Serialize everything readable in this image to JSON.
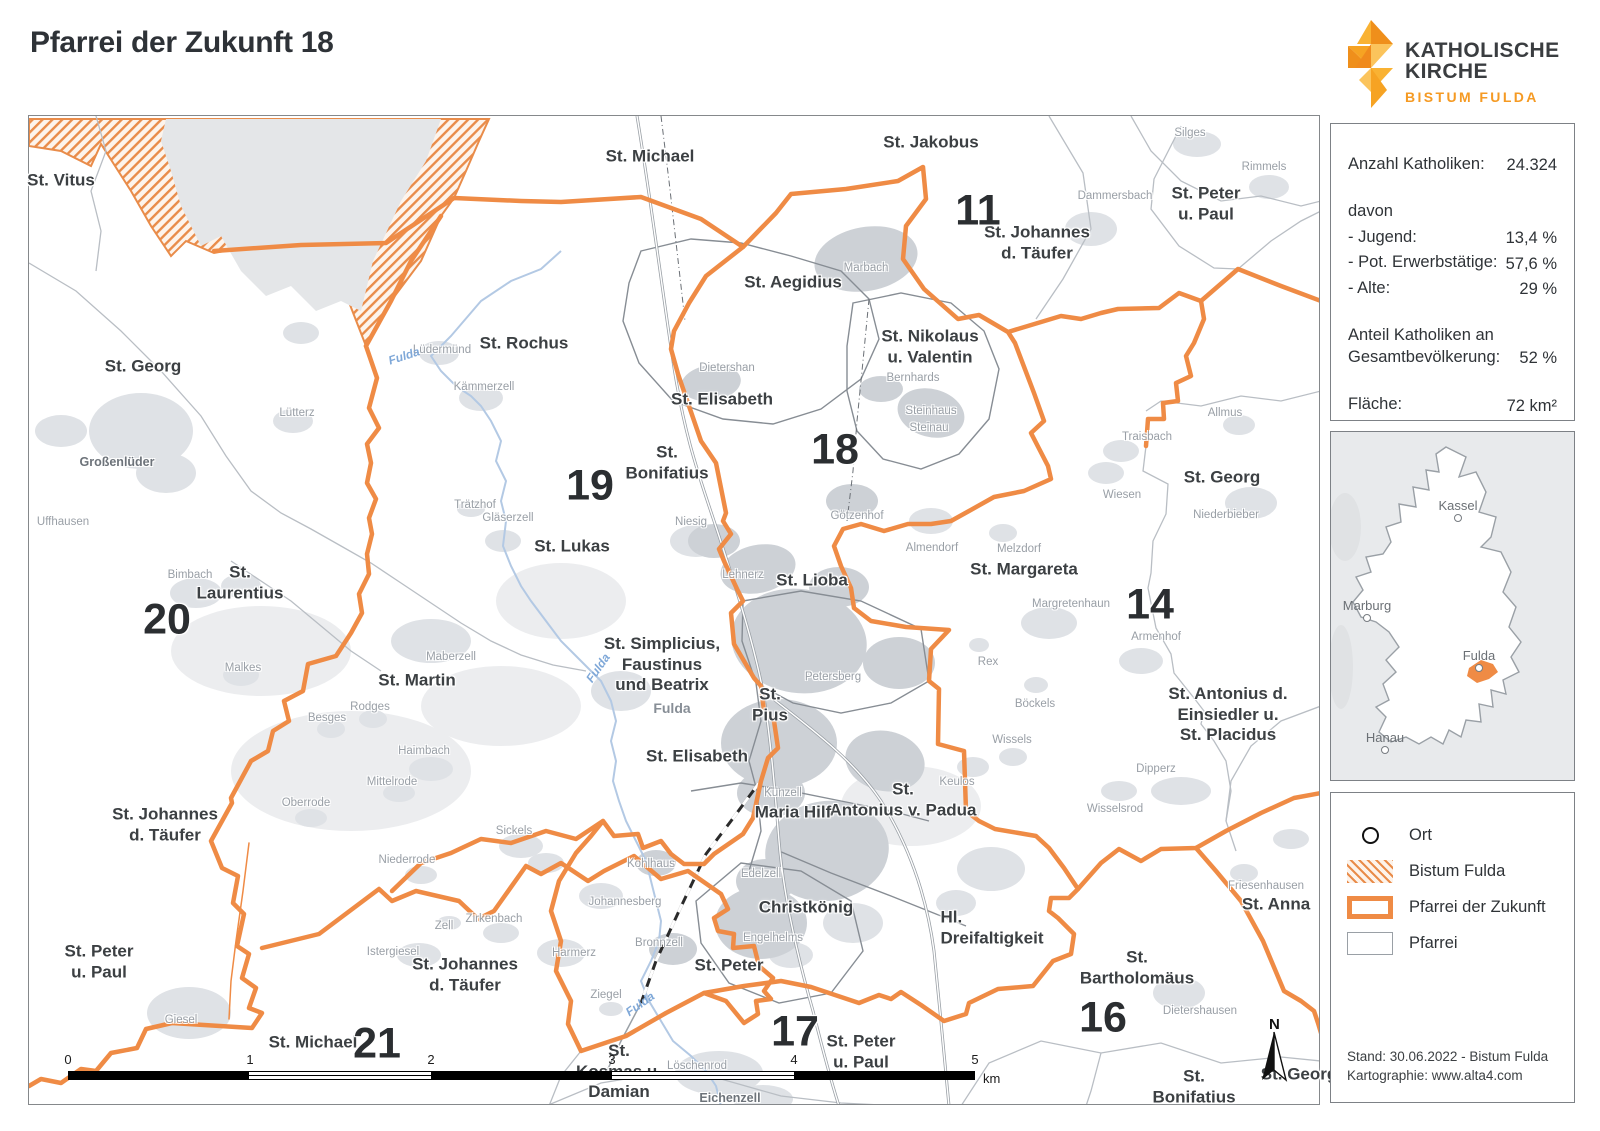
{
  "header": {
    "title": "Pfarrei der Zukunft 18",
    "logo": {
      "line1": "KATHOLISCHE",
      "line2": "KIRCHE",
      "line3": "BISTUM FULDA"
    }
  },
  "colors": {
    "accent": "#ef8b45",
    "logo_orange": "#f59a23",
    "hatch": "#e98c4a",
    "parish_line": "#b9bec4",
    "water": "#b3c9e4"
  },
  "stats": {
    "anzahl_label": "Anzahl Katholiken:",
    "anzahl_value": "24.324",
    "davon_label": "davon",
    "jugend_label": "- Jugend:",
    "jugend_value": "13,4 %",
    "erwerb_label": "- Pot. Erwerbstätige:",
    "erwerb_value": "57,6 %",
    "alte_label": "- Alte:",
    "alte_value": "29 %",
    "anteil_label": "Anteil Katholiken an\nGesamtbevölkerung:",
    "anteil_value": "52 %",
    "flaeche_label": "Fläche:",
    "flaeche_value": "72 km²"
  },
  "overview": {
    "cities": [
      {
        "name": "Kassel",
        "x": 127,
        "y": 86
      },
      {
        "name": "Marburg",
        "x": 36,
        "y": 186
      },
      {
        "name": "Fulda",
        "x": 148,
        "y": 236
      },
      {
        "name": "Hanau",
        "x": 54,
        "y": 318
      }
    ]
  },
  "legend": {
    "items": [
      {
        "label": "Ort"
      },
      {
        "label": "Bistum Fulda"
      },
      {
        "label": "Pfarrei der Zukunft"
      },
      {
        "label": "Pfarrei"
      }
    ],
    "footer_line1": "Stand: 30.06.2022 - Bistum Fulda",
    "footer_line2": "Kartographie: www.alta4.com"
  },
  "map": {
    "north_label": "N",
    "scale_bar": {
      "ticks": [
        {
          "text": "0",
          "x": 0,
          "y": -4
        },
        {
          "text": "1",
          "x": 182,
          "y": -4
        },
        {
          "text": "2",
          "x": 363,
          "y": -4
        },
        {
          "text": "3",
          "x": 544,
          "y": -4
        },
        {
          "text": "4",
          "x": 726,
          "y": -4
        },
        {
          "text": "5",
          "x": 907,
          "y": -4
        }
      ],
      "unit": "km"
    },
    "region_numbers": [
      {
        "text": "11",
        "x": 978,
        "y": 211
      },
      {
        "text": "18",
        "x": 835,
        "y": 450
      },
      {
        "text": "19",
        "x": 590,
        "y": 486
      },
      {
        "text": "20",
        "x": 167,
        "y": 620
      },
      {
        "text": "14",
        "x": 1150,
        "y": 605
      },
      {
        "text": "17",
        "x": 795,
        "y": 1032
      },
      {
        "text": "16",
        "x": 1103,
        "y": 1018
      },
      {
        "text": "21",
        "x": 377,
        "y": 1044
      }
    ],
    "parish_labels": [
      {
        "text": "St. Vitus",
        "x": 61,
        "y": 181
      },
      {
        "text": "St. Michael",
        "x": 650,
        "y": 157
      },
      {
        "text": "St. Jakobus",
        "x": 931,
        "y": 143
      },
      {
        "text": "St. Peter\nu. Paul",
        "x": 1206,
        "y": 204
      },
      {
        "text": "St. Johannes\nd. Täufer",
        "x": 1037,
        "y": 243
      },
      {
        "text": "St. Aegidius",
        "x": 793,
        "y": 283
      },
      {
        "text": "St. Nikolaus\nu. Valentin",
        "x": 930,
        "y": 347
      },
      {
        "text": "St. Rochus",
        "x": 524,
        "y": 344
      },
      {
        "text": "St. Georg",
        "x": 143,
        "y": 367
      },
      {
        "text": "St. Elisabeth",
        "x": 722,
        "y": 400
      },
      {
        "text": "St.\nBonifatius",
        "x": 667,
        "y": 463
      },
      {
        "text": "St. Georg",
        "x": 1222,
        "y": 478
      },
      {
        "text": "St. Lukas",
        "x": 572,
        "y": 547
      },
      {
        "text": "St.\nLaurentius",
        "x": 240,
        "y": 583
      },
      {
        "text": "St. Lioba",
        "x": 812,
        "y": 581
      },
      {
        "text": "St. Margareta",
        "x": 1024,
        "y": 570
      },
      {
        "text": "St. Simplicius,\nFaustinus\nund Beatrix",
        "x": 662,
        "y": 665
      },
      {
        "text": "St. Martin",
        "x": 417,
        "y": 681
      },
      {
        "text": "St. Antonius d.\nEinsiedler u.\nSt. Placidus",
        "x": 1228,
        "y": 715
      },
      {
        "text": "St.\nPius",
        "x": 770,
        "y": 705
      },
      {
        "text": "St. Elisabeth",
        "x": 697,
        "y": 757
      },
      {
        "text": "St.\nAntonius v. Padua",
        "x": 903,
        "y": 800
      },
      {
        "text": "Maria Hilf",
        "x": 793,
        "y": 813
      },
      {
        "text": "St. Johannes\nd. Täufer",
        "x": 165,
        "y": 825
      },
      {
        "text": "Christkönig",
        "x": 806,
        "y": 908
      },
      {
        "text": "Hl.\nDreifaltigkeit",
        "x": 992,
        "y": 928,
        "cls": "align-left"
      },
      {
        "text": "St. Anna",
        "x": 1276,
        "y": 905
      },
      {
        "text": "St. Peter\nu. Paul",
        "x": 99,
        "y": 962
      },
      {
        "text": "St. Johannes\nd. Täufer",
        "x": 465,
        "y": 975
      },
      {
        "text": "St. Peter",
        "x": 729,
        "y": 966
      },
      {
        "text": "St.\nBartholomäus",
        "x": 1137,
        "y": 968
      },
      {
        "text": "St. Michael",
        "x": 313,
        "y": 1043
      },
      {
        "text": "St. Peter\nu. Paul",
        "x": 861,
        "y": 1052
      },
      {
        "text": "St.\nKosmas u.\nDamian",
        "x": 619,
        "y": 1072
      },
      {
        "text": "St.\nBonifatius",
        "x": 1194,
        "y": 1087
      },
      {
        "text": "St. Georg",
        "x": 1299,
        "y": 1075
      }
    ],
    "place_labels": [
      {
        "text": "Silges",
        "x": 1190,
        "y": 133
      },
      {
        "text": "Rimmels",
        "x": 1264,
        "y": 167
      },
      {
        "text": "Dammersbach",
        "x": 1115,
        "y": 196
      },
      {
        "text": "Marbach",
        "x": 866,
        "y": 268
      },
      {
        "text": "Dietershan",
        "x": 727,
        "y": 368
      },
      {
        "text": "Bernhards",
        "x": 913,
        "y": 378
      },
      {
        "text": "Steinhaus",
        "x": 931,
        "y": 411
      },
      {
        "text": "Steinau",
        "x": 929,
        "y": 428
      },
      {
        "text": "Lüdermünd",
        "x": 442,
        "y": 350
      },
      {
        "text": "Kämmerzell",
        "x": 484,
        "y": 387
      },
      {
        "text": "Lütterz",
        "x": 297,
        "y": 413
      },
      {
        "text": "Großenlüder",
        "x": 117,
        "y": 462,
        "cls": "strong"
      },
      {
        "text": "Uffhausen",
        "x": 63,
        "y": 522
      },
      {
        "text": "Trätzhof",
        "x": 475,
        "y": 505
      },
      {
        "text": "Gläserzell",
        "x": 508,
        "y": 518
      },
      {
        "text": "Niesig",
        "x": 691,
        "y": 522
      },
      {
        "text": "Bimbach",
        "x": 190,
        "y": 575
      },
      {
        "text": "Malkes",
        "x": 243,
        "y": 668
      },
      {
        "text": "Maberzell",
        "x": 451,
        "y": 657
      },
      {
        "text": "Rodges",
        "x": 370,
        "y": 707
      },
      {
        "text": "Besges",
        "x": 327,
        "y": 718
      },
      {
        "text": "Haimbach",
        "x": 424,
        "y": 751
      },
      {
        "text": "Mittelrode",
        "x": 392,
        "y": 782
      },
      {
        "text": "Oberrode",
        "x": 306,
        "y": 803
      },
      {
        "text": "Sickels",
        "x": 514,
        "y": 831
      },
      {
        "text": "Niederrode",
        "x": 407,
        "y": 860
      },
      {
        "text": "Zell",
        "x": 444,
        "y": 926
      },
      {
        "text": "Zirkenbach",
        "x": 494,
        "y": 919
      },
      {
        "text": "Istergiesel",
        "x": 393,
        "y": 952
      },
      {
        "text": "Harmerz",
        "x": 574,
        "y": 953
      },
      {
        "text": "Johannesberg",
        "x": 625,
        "y": 902
      },
      {
        "text": "Kohlhaus",
        "x": 651,
        "y": 864
      },
      {
        "text": "Bronnzell",
        "x": 659,
        "y": 943
      },
      {
        "text": "Ziegel",
        "x": 606,
        "y": 995
      },
      {
        "text": "Giesel",
        "x": 181,
        "y": 1020
      },
      {
        "text": "Edelzell",
        "x": 761,
        "y": 874
      },
      {
        "text": "Engelhelms",
        "x": 773,
        "y": 938
      },
      {
        "text": "Löschenrod",
        "x": 697,
        "y": 1066
      },
      {
        "text": "Eichenzell",
        "x": 730,
        "y": 1098,
        "cls": "strong"
      },
      {
        "text": "Petersberg",
        "x": 833,
        "y": 677
      },
      {
        "text": "Künzell",
        "x": 783,
        "y": 793
      },
      {
        "text": "Keulos",
        "x": 957,
        "y": 782
      },
      {
        "text": "Almendorf",
        "x": 932,
        "y": 548
      },
      {
        "text": "Melzdorf",
        "x": 1019,
        "y": 549
      },
      {
        "text": "Margretenhaun",
        "x": 1071,
        "y": 604
      },
      {
        "text": "Armenhof",
        "x": 1156,
        "y": 637
      },
      {
        "text": "Rex",
        "x": 988,
        "y": 662
      },
      {
        "text": "Böckels",
        "x": 1035,
        "y": 704
      },
      {
        "text": "Wissels",
        "x": 1012,
        "y": 740
      },
      {
        "text": "Wiesen",
        "x": 1122,
        "y": 495
      },
      {
        "text": "Traisbach",
        "x": 1147,
        "y": 437
      },
      {
        "text": "Allmus",
        "x": 1225,
        "y": 413
      },
      {
        "text": "Niederbieber",
        "x": 1226,
        "y": 515
      },
      {
        "text": "Dipperz",
        "x": 1156,
        "y": 769
      },
      {
        "text": "Wisselsrod",
        "x": 1115,
        "y": 809
      },
      {
        "text": "Friesenhausen",
        "x": 1266,
        "y": 886
      },
      {
        "text": "Dietershausen",
        "x": 1200,
        "y": 1011
      },
      {
        "text": "Lehnerz",
        "x": 743,
        "y": 575
      },
      {
        "text": "Götzenhof",
        "x": 857,
        "y": 516
      },
      {
        "text": "Fulda",
        "x": 672,
        "y": 708,
        "cls": "city"
      }
    ],
    "river_labels": [
      {
        "text": "Fulda",
        "x": 404,
        "y": 356,
        "rot": -18
      },
      {
        "text": "Fulda",
        "x": 598,
        "y": 668,
        "rot": -55
      },
      {
        "text": "Fulda",
        "x": 640,
        "y": 1004,
        "rot": -35
      }
    ]
  }
}
